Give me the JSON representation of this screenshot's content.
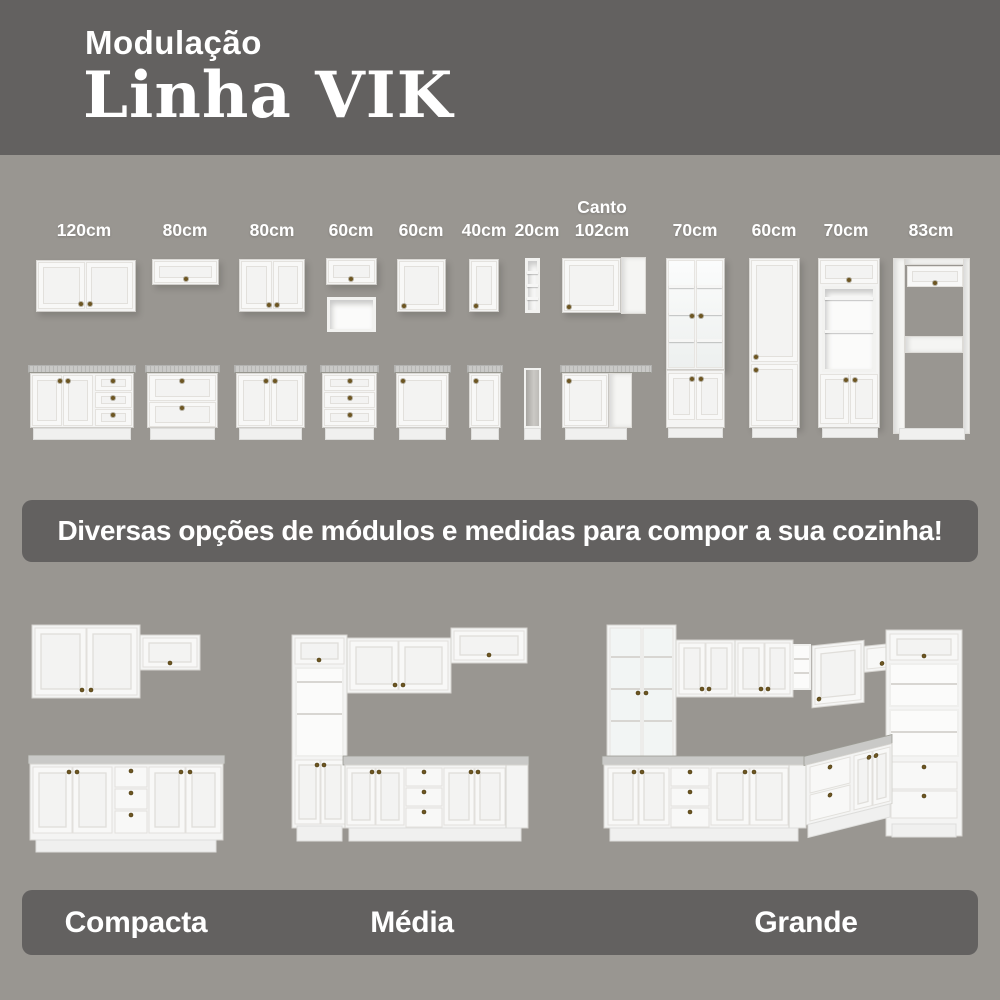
{
  "header": {
    "kicker": "Modulação",
    "title": "Linha VIK"
  },
  "banner": {
    "text": "Diversas opções de módulos e medidas para compor a sua cozinha!"
  },
  "modules": [
    {
      "size": "120cm"
    },
    {
      "size": "80cm"
    },
    {
      "size": "80cm"
    },
    {
      "size": "60cm"
    },
    {
      "size": "60cm"
    },
    {
      "size": "40cm"
    },
    {
      "size": "20cm"
    },
    {
      "prefix": "Canto",
      "size": "102cm"
    },
    {
      "size": "70cm"
    },
    {
      "size": "60cm"
    },
    {
      "size": "70cm"
    },
    {
      "size": "83cm"
    }
  ],
  "kitchens": [
    {
      "name": "Compacta"
    },
    {
      "name": "Média"
    },
    {
      "name": "Grande"
    }
  ],
  "colors": {
    "background": "#999691",
    "band": "#636160",
    "cabinet": "#f4f4f3",
    "countertop": "#c9c9c7",
    "knob": "#6d5622",
    "text": "#ffffff"
  }
}
